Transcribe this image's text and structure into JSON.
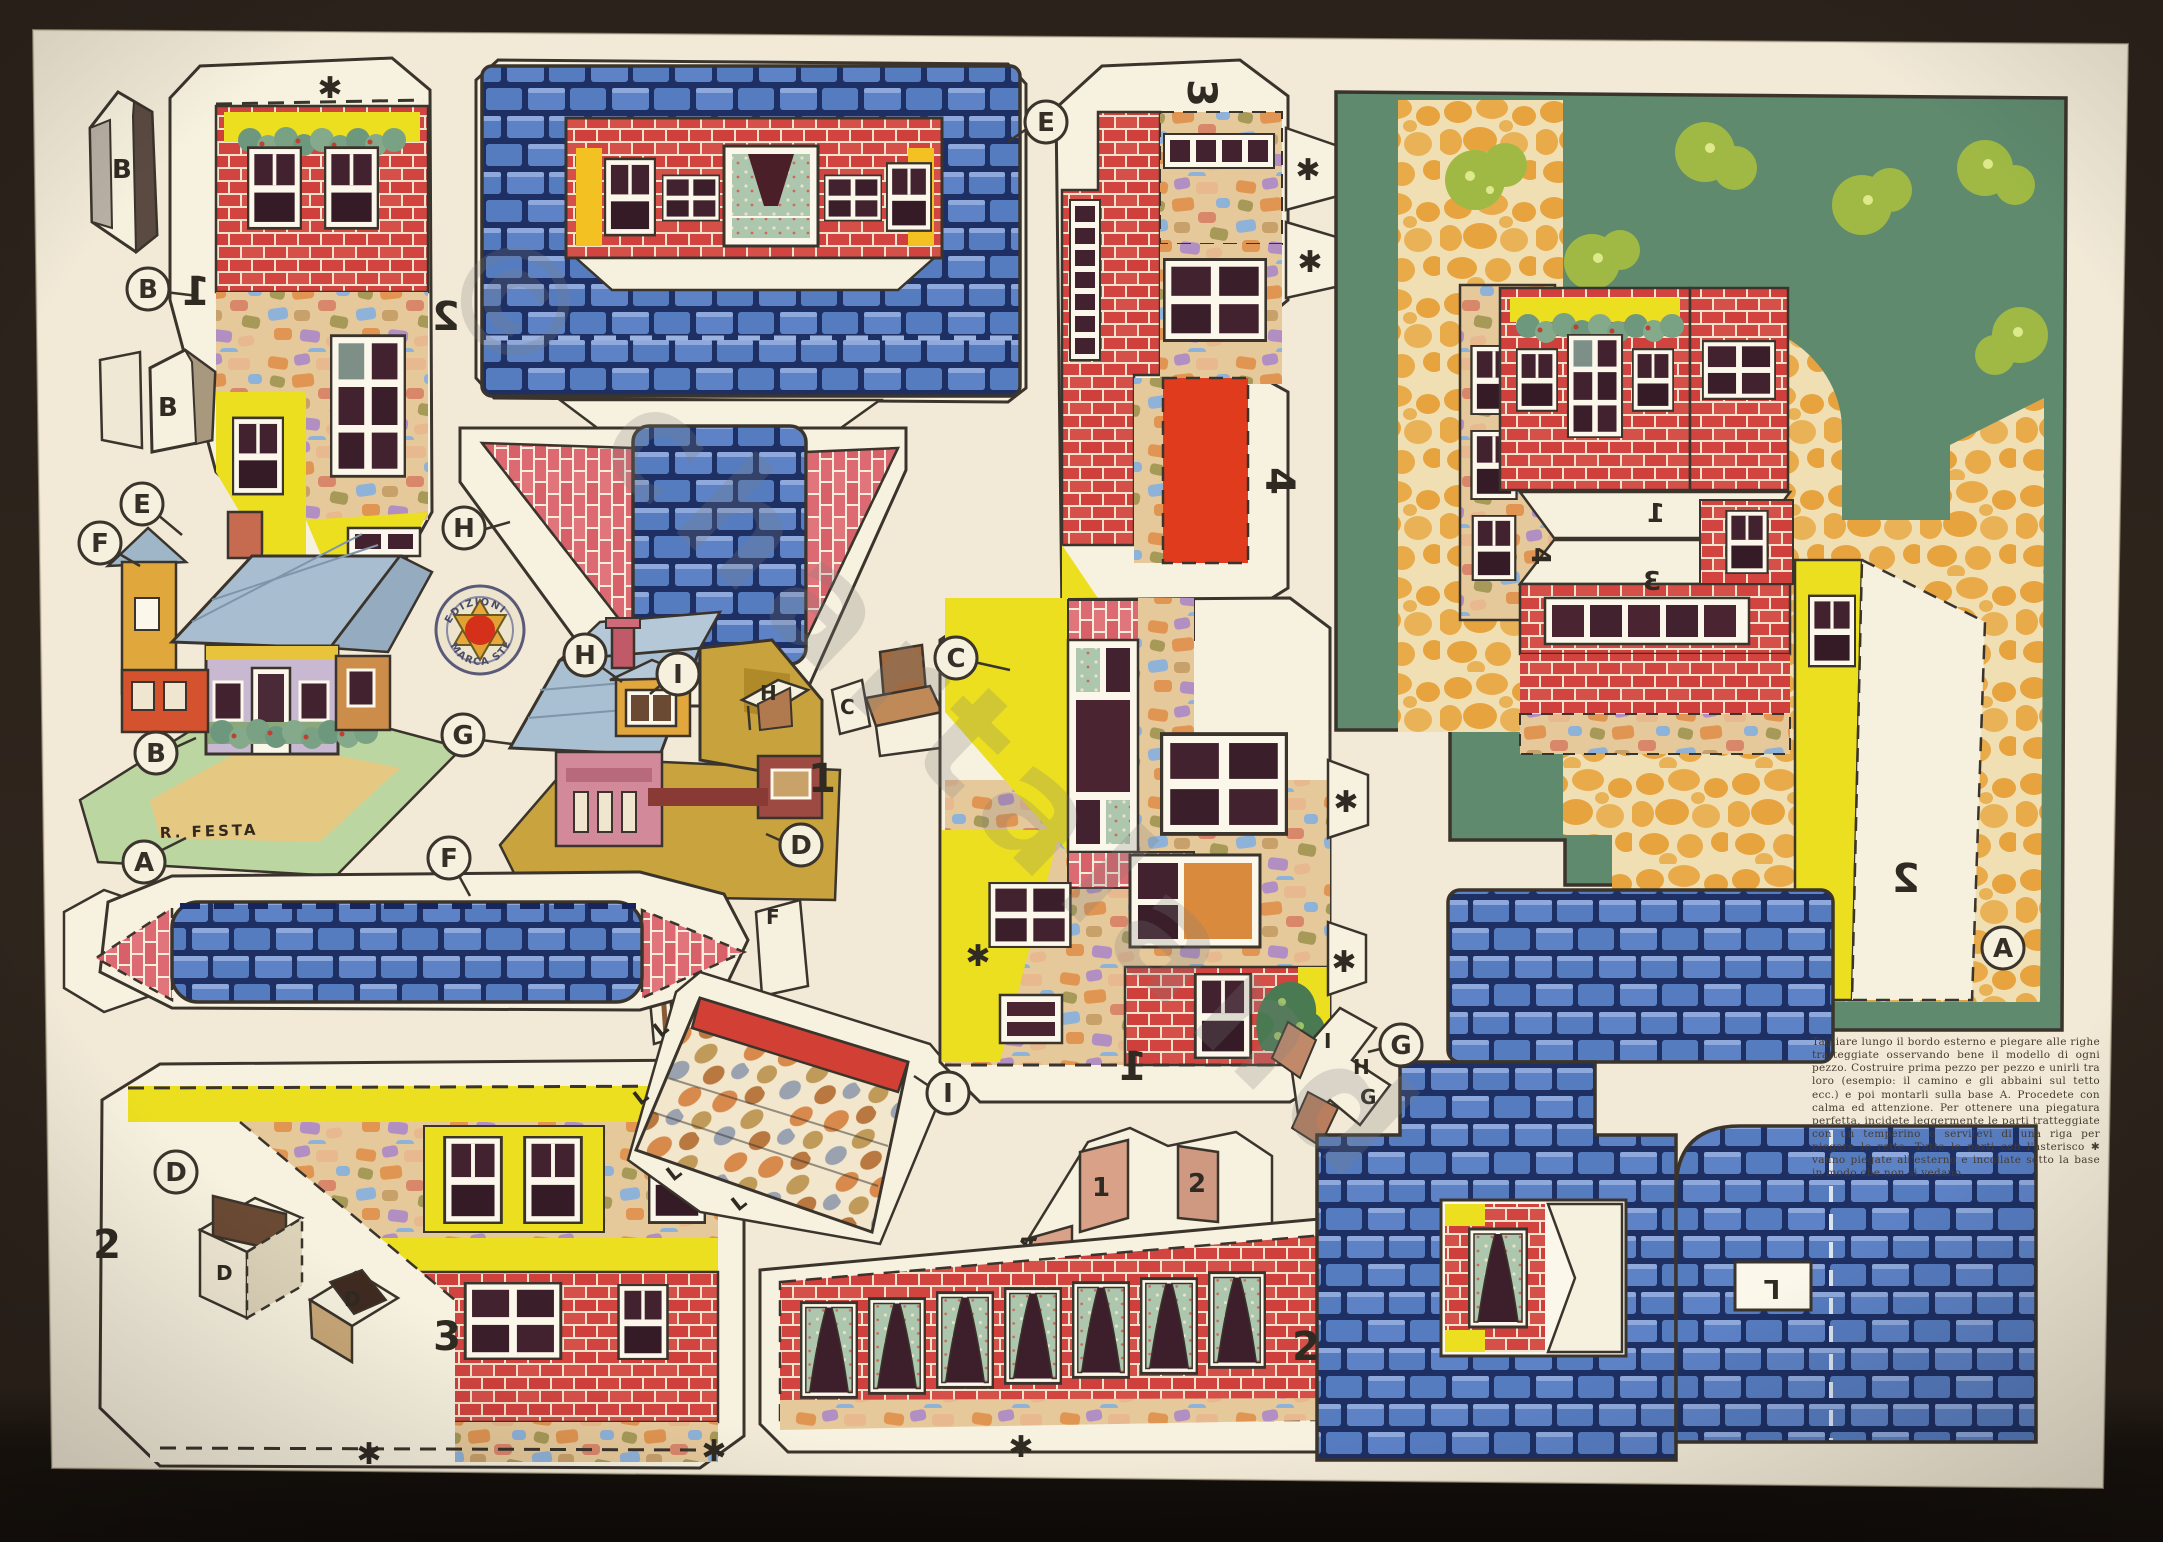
{
  "sheet": {
    "publisher_logo": {
      "arc_top": "EDIZIONI",
      "arc_bottom": "MARCA STELLA"
    },
    "artist_signature": "R. FESTA",
    "watermark": "© chartaland",
    "fold_marker": "✱",
    "instructions": "Tagliare lungo il bordo esterno e piegare alle righe tratteggiate osservando bene il modello di ogni pezzo. Costruire prima pezzo per pezzo e unirli tra loro (esempio: il camino e gli abbaini sul tetto ecc.) e poi montarli sulla base A. Procedete con calma ed attenzione. Per ottenere una piegatura perfetta, incidete leggermente le parti tratteggiate con un temperino e servitevi di una riga per piegare le rette. Tutte le parti con l'asterisco ✱ vanno piegate all'esterno e incollate sotto la base in modo che non si vedano.",
    "callouts": [
      {
        "letter": "B"
      },
      {
        "letter": "E"
      },
      {
        "letter": "F"
      },
      {
        "letter": "H"
      },
      {
        "letter": "E"
      },
      {
        "letter": "C"
      },
      {
        "letter": "H"
      },
      {
        "letter": "I"
      },
      {
        "letter": "G"
      },
      {
        "letter": "B"
      },
      {
        "letter": "A"
      },
      {
        "letter": "D"
      },
      {
        "letter": "F"
      },
      {
        "letter": "I"
      },
      {
        "letter": "G"
      },
      {
        "letter": "D"
      },
      {
        "letter": "A"
      }
    ],
    "numerals": [
      {
        "text": "1"
      },
      {
        "text": "2"
      },
      {
        "text": "1"
      },
      {
        "text": "3"
      },
      {
        "text": "4"
      },
      {
        "text": "2"
      },
      {
        "text": "3"
      },
      {
        "text": "1"
      },
      {
        "text": "2"
      },
      {
        "text": "1"
      },
      {
        "text": "3"
      },
      {
        "text": "4"
      },
      {
        "text": "2"
      }
    ],
    "tab_numbers": [
      "1",
      "2",
      "4",
      "3"
    ],
    "piece_letters": [
      "B",
      "B",
      "H",
      "C",
      "F",
      "I",
      "L",
      "L",
      "L",
      "L",
      "D",
      "D",
      "I",
      "H",
      "G",
      "A",
      "L"
    ],
    "colors": {
      "paper": "#f2ead7",
      "ink": "#3a342c",
      "brick_red": "#d14440",
      "brick_pink": "#dd6a72",
      "roof_blue": "#5d82c6",
      "roof_gap_navy": "#1d2f63",
      "wall_yellow": "#ebdf1f",
      "cobble_orange": "#e7a43e",
      "base_green": "#5f8a6e",
      "bush_green": "#9fb944",
      "roof_panel_red": "#e03b1d",
      "mosaic_tan": "#e6c99b",
      "pane_dark": "#42222e"
    }
  }
}
